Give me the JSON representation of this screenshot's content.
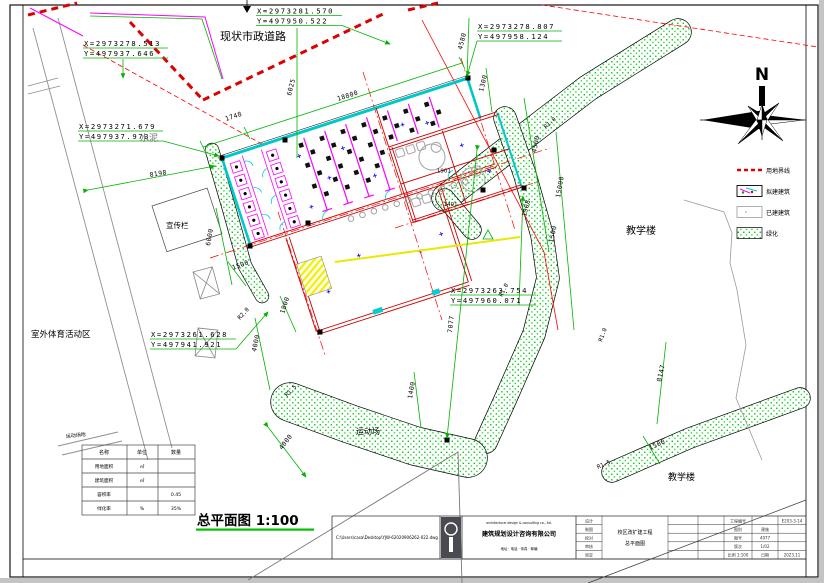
{
  "coords": [
    {
      "x": "X=2973278.513",
      "y": "Y=497937.646"
    },
    {
      "x": "X=2973281.570",
      "y": "Y=497950.522"
    },
    {
      "x": "X=2973278.807",
      "y": "Y=497958.124"
    },
    {
      "x": "X=2973271.679",
      "y": "Y=497937.973"
    },
    {
      "x": "X=2973261.628",
      "y": "Y=497941.921"
    },
    {
      "x": "X=2973263.754",
      "y": "Y=497960.071"
    }
  ],
  "dims": [
    "1748",
    "18800",
    "6025",
    "4580",
    "8198",
    "6000",
    "1500",
    "4500",
    "15000",
    "1908",
    "1500",
    "1300",
    "7077",
    "1800",
    "4000",
    "8147",
    "4000",
    "1400",
    "1500"
  ],
  "radii": [
    "R1.0",
    "R1.0",
    "R2.0",
    "R1.5",
    "R1.5",
    "R1.0"
  ],
  "rooms": [
    "1901",
    "1401"
  ],
  "labels": {
    "top_road": "现状市政道路",
    "cement": "水泥",
    "board": "宣传栏",
    "outdoor_area": "室外体育活动区",
    "field": "运动场",
    "teach_right": "教学楼",
    "teach_bottom": "教学楼",
    "field_small": "运动场地"
  },
  "north": {
    "letter": "N"
  },
  "legend": {
    "items": [
      {
        "label": "用地界线"
      },
      {
        "label": "拟建建筑"
      },
      {
        "label": "已建建筑"
      },
      {
        "label": "绿化"
      }
    ]
  },
  "table": {
    "headers": [
      "名称",
      "单位",
      "数量"
    ],
    "rows": [
      [
        "用地面积",
        "㎡",
        ""
      ],
      [
        "建筑面积",
        "㎡",
        ""
      ],
      [
        "容积率",
        "",
        "0.45"
      ],
      [
        "绿化率",
        "%",
        "35%"
      ]
    ]
  },
  "scale": {
    "label": "总平面图 1:100"
  },
  "title_block": {
    "file_path": "C:\\Users\\casa\\Desktop\\YJW-62020906262-022.dwg",
    "company_en": "architectural design & consulting co., ltd.",
    "company_cn": "建筑规划设计咨询有限公司",
    "company_info": "地址 · 电话 · 传真 · 邮编",
    "project_name": "校区改扩建工程",
    "drawing_name": "总平面图",
    "grid": [
      [
        "设计",
        "",
        "",
        "工程编号",
        "",
        "E203-3-14"
      ],
      [
        "制图",
        "",
        "",
        "图别",
        "建施",
        ""
      ],
      [
        "校对",
        "",
        "",
        "图号",
        "4977",
        ""
      ],
      [
        "审核",
        "",
        "",
        "版次",
        "1/02",
        ""
      ],
      [
        "审定",
        "",
        "",
        "比例 1:100",
        "日期",
        "2023.11"
      ]
    ]
  }
}
